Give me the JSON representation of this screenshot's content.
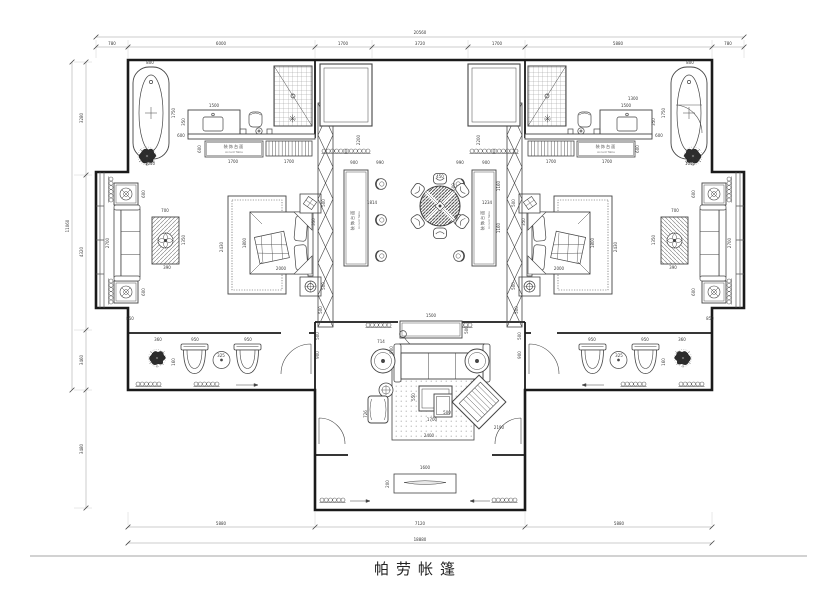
{
  "title": "帕劳帐篷",
  "labels": {
    "accent_table_zh": "装饰台面",
    "accent_table_en": "Accent Table"
  },
  "colors": {
    "wall": "#1a1a1a",
    "line": "#444444",
    "dim": "#3a3a3a",
    "hatch": "#888888"
  },
  "dimensions": {
    "top_total": "20560",
    "top_chain": [
      "780",
      "6000",
      "1700",
      "3720",
      "1700",
      "5880",
      "780"
    ],
    "bottom_chain": [
      "5880",
      "7120",
      "5880"
    ],
    "bottom_total": "18880",
    "left_chain": [
      "3280",
      "4320",
      "3460",
      "3480"
    ],
    "left_total": "11060"
  },
  "dim_labels": [
    {
      "t": "20560",
      "x": 420,
      "y": 34
    },
    {
      "t": "780",
      "x": 112,
      "y": 45
    },
    {
      "t": "6000",
      "x": 221,
      "y": 45
    },
    {
      "t": "1700",
      "x": 343,
      "y": 45
    },
    {
      "t": "3720",
      "x": 420,
      "y": 45
    },
    {
      "t": "1700",
      "x": 497,
      "y": 45
    },
    {
      "t": "5880",
      "x": 618,
      "y": 45
    },
    {
      "t": "780",
      "x": 728,
      "y": 45
    },
    {
      "t": "5880",
      "x": 221,
      "y": 525
    },
    {
      "t": "7120",
      "x": 420,
      "y": 525
    },
    {
      "t": "5880",
      "x": 619,
      "y": 525
    },
    {
      "t": "18880",
      "x": 420,
      "y": 541
    },
    {
      "t": "3280",
      "x": 83,
      "y": 118,
      "r": 1
    },
    {
      "t": "4320",
      "x": 83,
      "y": 252,
      "r": 1
    },
    {
      "t": "3460",
      "x": 83,
      "y": 360,
      "r": 1
    },
    {
      "t": "3480",
      "x": 83,
      "y": 449,
      "r": 1
    },
    {
      "t": "11060",
      "x": 69,
      "y": 226,
      "r": 1
    },
    {
      "t": "800",
      "x": 150,
      "y": 64,
      "m": 1
    },
    {
      "t": "1750",
      "x": 175,
      "y": 113,
      "r": 1,
      "m": 1
    },
    {
      "t": "1040",
      "x": 150,
      "y": 165,
      "m": 1
    },
    {
      "t": "1500",
      "x": 214,
      "y": 107,
      "m": 1
    },
    {
      "t": "350",
      "x": 185,
      "y": 122,
      "r": 1,
      "m": 1
    },
    {
      "t": "600",
      "x": 181,
      "y": 137,
      "m": 1
    },
    {
      "t": "1700",
      "x": 233,
      "y": 163,
      "m": 1
    },
    {
      "t": "1700",
      "x": 289,
      "y": 163,
      "m": 1
    },
    {
      "t": "600",
      "x": 201,
      "y": 149,
      "r": 1,
      "m": 1
    },
    {
      "t": "2200",
      "x": 360,
      "y": 140,
      "r": 1,
      "m": 1
    },
    {
      "t": "2430",
      "x": 223,
      "y": 247,
      "r": 1,
      "m": 1
    },
    {
      "t": "1800",
      "x": 246,
      "y": 243,
      "r": 1,
      "m": 1
    },
    {
      "t": "2000",
      "x": 281,
      "y": 270,
      "m": 1
    },
    {
      "t": "500",
      "x": 325,
      "y": 203,
      "r": 1,
      "m": 1
    },
    {
      "t": "500",
      "x": 325,
      "y": 286,
      "r": 1,
      "m": 1
    },
    {
      "t": "350",
      "x": 315,
      "y": 222,
      "r": 1,
      "m": 1
    },
    {
      "t": "600",
      "x": 145,
      "y": 194,
      "r": 1,
      "m": 1
    },
    {
      "t": "2700",
      "x": 109,
      "y": 243,
      "r": 1,
      "m": 1
    },
    {
      "t": "700",
      "x": 165,
      "y": 212,
      "m": 1
    },
    {
      "t": "1350",
      "x": 185,
      "y": 240,
      "r": 1,
      "m": 1
    },
    {
      "t": "390",
      "x": 167,
      "y": 269,
      "m": 1
    },
    {
      "t": "600",
      "x": 145,
      "y": 292,
      "r": 1,
      "m": 1
    },
    {
      "t": "850",
      "x": 130,
      "y": 320,
      "m": 1
    },
    {
      "t": "360",
      "x": 158,
      "y": 341,
      "m": 1
    },
    {
      "t": "950",
      "x": 195,
      "y": 341,
      "m": 1
    },
    {
      "t": "325",
      "x": 221,
      "y": 357,
      "m": 1
    },
    {
      "t": "950",
      "x": 248,
      "y": 341,
      "m": 1
    },
    {
      "t": "160",
      "x": 175,
      "y": 362,
      "r": 1,
      "m": 1
    },
    {
      "t": "900",
      "x": 319,
      "y": 355,
      "r": 1,
      "m": 1
    },
    {
      "t": "500",
      "x": 319,
      "y": 336,
      "r": 1,
      "m": 1
    },
    {
      "t": "900",
      "x": 354,
      "y": 164,
      "m": 1
    },
    {
      "t": "990",
      "x": 380,
      "y": 164,
      "m": 1
    },
    {
      "t": "500",
      "x": 322,
      "y": 310,
      "r": 1,
      "m": 1
    },
    {
      "t": "450",
      "x": 440,
      "y": 178
    },
    {
      "t": "600",
      "x": 455,
      "y": 187,
      "r": 1
    },
    {
      "t": "1814",
      "x": 372,
      "y": 204
    },
    {
      "t": "1234",
      "x": 487,
      "y": 204
    },
    {
      "t": "1160",
      "x": 500,
      "y": 186,
      "r": 1
    },
    {
      "t": "1160",
      "x": 500,
      "y": 228,
      "r": 1
    },
    {
      "t": "1500",
      "x": 431,
      "y": 317
    },
    {
      "t": "500",
      "x": 468,
      "y": 330,
      "r": 1
    },
    {
      "t": "900",
      "x": 393,
      "y": 350,
      "r": 1
    },
    {
      "t": "714",
      "x": 381,
      "y": 343
    },
    {
      "t": "550",
      "x": 415,
      "y": 397,
      "r": 1
    },
    {
      "t": "500",
      "x": 447,
      "y": 414
    },
    {
      "t": "1700",
      "x": 432,
      "y": 421
    },
    {
      "t": "726",
      "x": 367,
      "y": 414,
      "r": 1
    },
    {
      "t": "2400",
      "x": 429,
      "y": 437
    },
    {
      "t": "2190",
      "x": 499,
      "y": 429
    },
    {
      "t": "1600",
      "x": 425,
      "y": 469
    },
    {
      "t": "200",
      "x": 389,
      "y": 484,
      "r": 1
    },
    {
      "t": "1300",
      "x": 633,
      "y": 100
    }
  ]
}
